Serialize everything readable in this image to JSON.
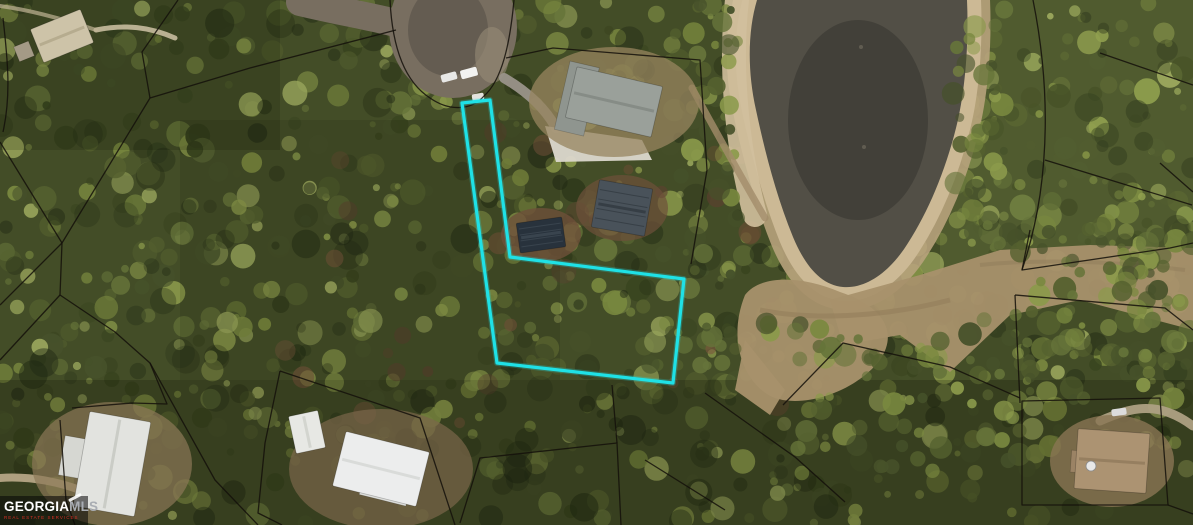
{
  "meta": {
    "width": 1193,
    "height": 525,
    "kind": "aerial-parcel-map"
  },
  "watermark": {
    "brand_primary": "GEORGIA",
    "brand_secondary": "MLS",
    "tagline": "REAL ESTATE SERVICES",
    "bar_color": "rgba(5,5,5,0.55)",
    "primary_color": "#ffffff",
    "secondary_color": "#a9adb3",
    "tagline_color": "#d93025"
  },
  "map": {
    "highlighted_lot": {
      "shape": "flag-lot",
      "outline_color": "#1FE1E6",
      "stroke_width": 3.2,
      "points": [
        [
          462,
          103
        ],
        [
          490,
          100
        ],
        [
          510,
          257
        ],
        [
          684,
          279
        ],
        [
          673,
          383
        ],
        [
          497,
          363
        ]
      ]
    },
    "parcel_line_color": "#14110a",
    "parcel_lines": [
      "M390,0 C392,42 402,80 430,98 C450,112 472,110 484,96 C502,80 510,44 514,0",
      "M506,58 L553,48 L700,60 L707,170 L691,264",
      "M396,30 L250,68 L150,98 L62,243 L60,295 L115,332 L150,363 L215,480 L258,525",
      "M0,142 L62,243",
      "M62,243 L0,305",
      "M60,295 L0,360",
      "M178,0 L142,52 L150,98",
      "M3,18 C8,62 11,96 3,132",
      "M72,408 L132,403 L167,404 L150,363",
      "M60,420 L66,500 L75,525",
      "M280,371 L420,418 L455,525",
      "M280,371 L265,443 L258,513 L282,525",
      "M460,523 L480,458 L617,443 L621,525",
      "M612,385 L617,443",
      "M645,460 L725,510",
      "M705,393 L795,457 L845,502",
      "M783,405 L843,343 L950,367 L1020,398",
      "M1033,0 C1045,60 1050,125 1040,195 C1035,228 1028,252 1022,270",
      "M1030,230 L1022,270 L1170,248 L1193,243",
      "M1100,53 L1193,85",
      "M1160,163 L1193,192",
      "M1045,160 L1192,205",
      "M1015,295 L1165,308 L1193,330",
      "M1015,295 L1020,403",
      "M1022,401 L1160,398 L1168,505 L1022,505 Z",
      "M1168,505 L1193,514"
    ],
    "terrain": {
      "forest_base": "#434d27",
      "canopy_palette": [
        "#55612f",
        "#66743a",
        "#79883f",
        "#8b9a4b",
        "#46512a",
        "#39441f",
        "#9aa65c"
      ],
      "shadow_color": "#1f2813",
      "rust_palette": [
        "#6b4c34",
        "#7a573d",
        "#5e4030"
      ],
      "canopy_count": 900,
      "shadow_count": 230,
      "rust_count": 30,
      "washes": [
        {
          "x": 0,
          "y": 380,
          "w": 1193,
          "h": 145,
          "color": "rgba(8,12,2,0.20)"
        },
        {
          "x": 0,
          "y": 0,
          "w": 280,
          "h": 150,
          "color": "rgba(8,12,2,0.15)"
        },
        {
          "x": 180,
          "y": 120,
          "w": 380,
          "h": 260,
          "color": "rgba(8,12,2,0.10)"
        },
        {
          "x": 940,
          "y": 0,
          "w": 253,
          "h": 270,
          "color": "rgba(200,215,120,0.10)"
        }
      ],
      "tree_patches": [
        {
          "x": 700,
          "y": 318,
          "w": 310,
          "h": 62,
          "n": 42
        },
        {
          "x": 950,
          "y": 222,
          "w": 243,
          "h": 42,
          "n": 30
        },
        {
          "x": 1015,
          "y": 300,
          "w": 178,
          "h": 100,
          "n": 48
        },
        {
          "x": 952,
          "y": 25,
          "w": 52,
          "h": 205,
          "n": 36
        },
        {
          "x": 688,
          "y": 0,
          "w": 52,
          "h": 285,
          "n": 38
        },
        {
          "x": 780,
          "y": 388,
          "w": 240,
          "h": 85,
          "n": 36
        },
        {
          "x": 1020,
          "y": 240,
          "w": 150,
          "h": 58,
          "n": 26
        },
        {
          "x": 415,
          "y": 58,
          "w": 32,
          "h": 48,
          "n": 12
        }
      ]
    },
    "pond": {
      "water_color": "#524f46",
      "water_dark_color": "rgba(38,38,34,0.35)",
      "water_d": "M757,0 C748,30 747,70 756,110 C765,152 776,195 793,237 C806,268 822,285 843,287 C866,289 890,272 908,243 C928,212 945,172 956,128 C965,93 969,45 967,0 Z",
      "halo_outer": {
        "color": "#b7a27c",
        "width": 46,
        "opacity": 0.9
      },
      "halo_inner": {
        "color": "#cdbb97",
        "width": 28,
        "opacity": 0.95
      },
      "left_strip": {
        "d": "M737,0 C730,60 735,140 755,215",
        "color": "#d2c09d",
        "width": 24,
        "opacity": 0.9
      },
      "mud_color": "#a8916c",
      "mud_paths": [
        "M745,295 C760,275 800,275 840,292 C880,305 900,330 880,360 C855,392 805,408 775,398 C748,388 725,345 745,295 Z",
        "M830,300 L920,275 L1000,250 L1090,245 L1193,248 L1193,330 L1080,300 L1010,315 L950,372 L900,335 L843,345 Z",
        "M745,340 L785,390 L770,415 L735,390 Z"
      ],
      "mud_streak_color": "#8f7a58",
      "spots": [
        {
          "cx": 861,
          "cy": 47,
          "r": 2
        },
        {
          "cx": 864,
          "cy": 147,
          "r": 2
        }
      ]
    },
    "roads": [
      {
        "name": "road-stem",
        "type": "stroke",
        "d": "M300,2 C350,14 395,20 432,34",
        "color": "#786e60",
        "width": 28,
        "opacity": 1
      },
      {
        "name": "cul-de-sac-bulb",
        "type": "ellipse",
        "cx": 453,
        "cy": 28,
        "rx": 64,
        "ry": 70,
        "color": "#786e60",
        "opacity": 1
      },
      {
        "name": "cul-de-sac-inner",
        "type": "ellipse",
        "cx": 448,
        "cy": 30,
        "rx": 40,
        "ry": 46,
        "color": "#5f574d",
        "opacity": 0.8
      },
      {
        "name": "cul-de-sac-edge",
        "type": "ellipse",
        "cx": 492,
        "cy": 55,
        "rx": 17,
        "ry": 28,
        "color": "#968a77",
        "opacity": 0.6
      },
      {
        "name": "driveway-top-left",
        "type": "stroke",
        "d": "M96,30 C125,24 150,27 175,38",
        "color": "#c8bc9e",
        "width": 5,
        "opacity": 0.9
      },
      {
        "name": "path-top-left-corner",
        "type": "stroke",
        "d": "M0,6 C30,10 60,18 96,30",
        "color": "#c0b496",
        "width": 4,
        "opacity": 0.7
      },
      {
        "name": "driveway-cul-de-sac-house",
        "type": "stroke",
        "d": "M504,78 C528,92 545,108 556,128",
        "color": "#9a948a",
        "width": 10,
        "opacity": 0.95
      },
      {
        "name": "concrete-pad",
        "type": "fill",
        "d": "M545,126 L642,140 L652,160 L556,162 Z",
        "color": "#dcd8ce",
        "opacity": 0.95
      },
      {
        "name": "driveway-bottom-left",
        "type": "stroke",
        "d": "M0,478 C28,476 55,481 80,490",
        "color": "#bcab8b",
        "width": 8,
        "opacity": 0.9
      },
      {
        "name": "driveway-bottom-right",
        "type": "stroke",
        "d": "M1100,421 C1132,407 1158,400 1193,426",
        "color": "#ada083",
        "width": 9,
        "opacity": 0.95
      },
      {
        "name": "trail-to-pond",
        "type": "stroke",
        "d": "M692,88 C715,130 740,175 765,218",
        "color": "#a28c6a",
        "width": 7,
        "opacity": 0.8
      }
    ],
    "buildings": [
      {
        "name": "house-top-left",
        "cx": 62,
        "cy": 36,
        "w": 54,
        "h": 36,
        "rot": -22,
        "roof": "#cdc3a8",
        "ridge": "#b3a88b",
        "wing": {
          "dx": -22,
          "dy": 10,
          "w": 16,
          "h": 16,
          "color": "#a49a86"
        }
      },
      {
        "name": "house-top-center",
        "cx": 614,
        "cy": 102,
        "w": 88,
        "h": 52,
        "rot": 13,
        "roof": "#9aa09a",
        "ridge": "#838983",
        "wing": {
          "dx": -8,
          "dy": -4,
          "w": 30,
          "h": 70,
          "color": "#8f958f"
        },
        "yard": {
          "rx": 85,
          "ry": 55,
          "color": "#97845f",
          "opacity": 0.75
        }
      },
      {
        "name": "construction-small",
        "cx": 541,
        "cy": 235,
        "w": 46,
        "h": 30,
        "rot": -8,
        "roof": "#28323c",
        "ridge": "#3d4852",
        "truss": true,
        "yard": {
          "rx": 40,
          "ry": 27,
          "color": "#6e503a",
          "opacity": 0.8
        }
      },
      {
        "name": "construction-large",
        "cx": 622,
        "cy": 208,
        "w": 54,
        "h": 48,
        "rot": 10,
        "roof": "#49525a",
        "ridge": "#333b42",
        "truss": true,
        "yard": {
          "rx": 46,
          "ry": 33,
          "color": "#6e503a",
          "opacity": 0.7
        }
      },
      {
        "name": "house-bottom-left",
        "cx": 112,
        "cy": 464,
        "w": 62,
        "h": 96,
        "rot": 10,
        "roof": "#e2e3df",
        "ridge": "#c6c8c2",
        "wing": {
          "dx": -20,
          "dy": 28,
          "w": 36,
          "h": 40,
          "color": "#d6d7d2"
        },
        "yard": {
          "rx": 80,
          "ry": 62,
          "color": "#8b7857",
          "opacity": 0.7
        }
      },
      {
        "name": "outbuilding-bottom-center",
        "cx": 307,
        "cy": 432,
        "w": 30,
        "h": 38,
        "rot": -12,
        "roof": "#e7e8e4",
        "ridge": "#d0d2cc"
      },
      {
        "name": "house-bottom-center",
        "cx": 381,
        "cy": 469,
        "w": 86,
        "h": 56,
        "rot": 14,
        "roof": "#eceded",
        "ridge": "#d6d8d6",
        "wing": {
          "dx": 28,
          "dy": 18,
          "w": 48,
          "h": 40,
          "color": "#dddedb"
        },
        "yard": {
          "rx": 92,
          "ry": 60,
          "color": "#7a674a",
          "opacity": 0.7
        }
      },
      {
        "name": "house-bottom-right",
        "cx": 1112,
        "cy": 461,
        "w": 72,
        "h": 60,
        "rot": 4,
        "roof": "#ac9372",
        "ridge": "#937c5e",
        "wing": {
          "dx": -5,
          "dy": 22,
          "w": 44,
          "h": 22,
          "color": "#9b8365"
        },
        "yard": {
          "rx": 62,
          "ry": 46,
          "color": "#8a7654",
          "opacity": 0.8
        }
      }
    ],
    "cars": [
      {
        "name": "car-cul-de-sac-1",
        "x": 449,
        "y": 77,
        "w": 16,
        "h": 8,
        "rot": -15,
        "color": "#e8e8e6"
      },
      {
        "name": "car-cul-de-sac-2",
        "x": 469,
        "y": 73,
        "w": 17,
        "h": 9,
        "rot": -15,
        "color": "#f2f2f0"
      },
      {
        "name": "car-lot-entrance",
        "x": 478,
        "y": 97,
        "w": 12,
        "h": 7,
        "rot": -10,
        "color": "#e4e2de"
      },
      {
        "name": "car-bottom-right",
        "x": 1119,
        "y": 412,
        "w": 15,
        "h": 7,
        "rot": -8,
        "color": "#dcdcdc"
      }
    ],
    "features": [
      {
        "name": "pond",
        "cx": 858,
        "cy": 140
      },
      {
        "name": "sandy-shoreline",
        "cx": 758,
        "cy": 120
      },
      {
        "name": "mud-flat",
        "cx": 940,
        "cy": 310
      },
      {
        "name": "cul-de-sac",
        "cx": 452,
        "cy": 35
      },
      {
        "name": "satellite-dish",
        "cx": 1091,
        "cy": 466
      }
    ]
  }
}
